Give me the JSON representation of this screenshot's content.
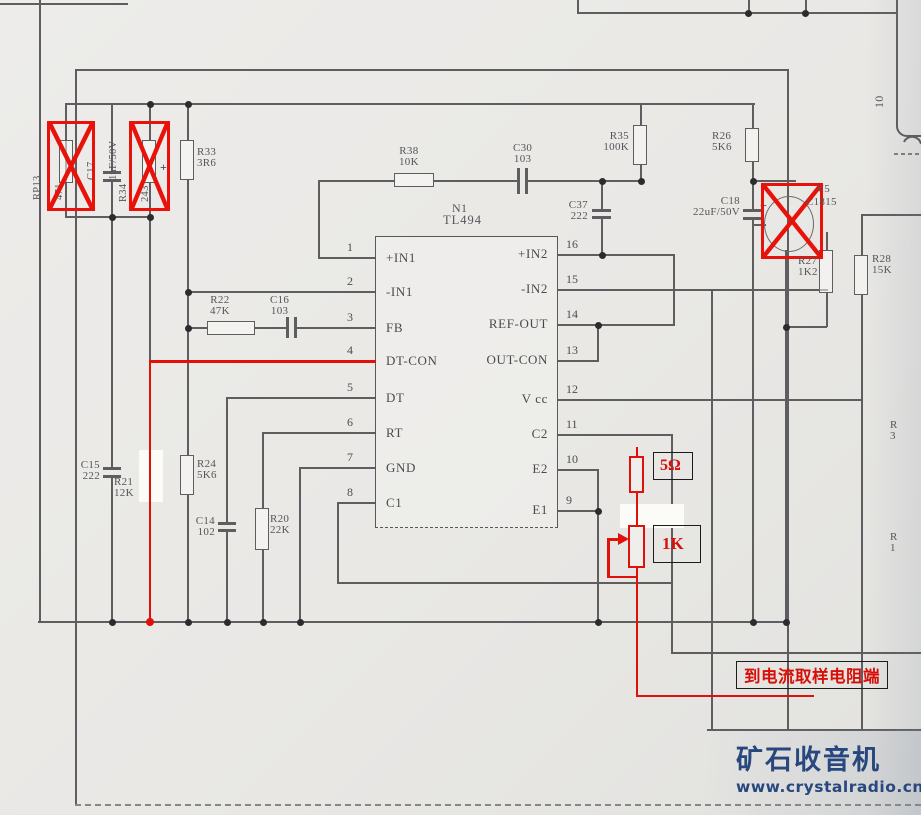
{
  "schematic": {
    "ic": {
      "designator": "N1",
      "part": "TL494",
      "left_pins": [
        {
          "n": "1",
          "label": "+IN1"
        },
        {
          "n": "2",
          "label": "-IN1"
        },
        {
          "n": "3",
          "label": "FB"
        },
        {
          "n": "4",
          "label": "DT-CON"
        },
        {
          "n": "5",
          "label": "DT"
        },
        {
          "n": "6",
          "label": "RT"
        },
        {
          "n": "7",
          "label": "GND"
        },
        {
          "n": "8",
          "label": "C1"
        }
      ],
      "right_pins": [
        {
          "n": "16",
          "label": "+IN2"
        },
        {
          "n": "15",
          "label": "-IN2"
        },
        {
          "n": "14",
          "label": "REF-OUT"
        },
        {
          "n": "13",
          "label": "OUT-CON"
        },
        {
          "n": "12",
          "label": "V cc"
        },
        {
          "n": "11",
          "label": "C2"
        },
        {
          "n": "10",
          "label": "E2"
        },
        {
          "n": "9",
          "label": "E1"
        }
      ]
    },
    "components": {
      "rp13": {
        "ref": "RP13",
        "val": "471"
      },
      "c17": {
        "ref": "C17",
        "val": "1uF/50V"
      },
      "r34": {
        "ref": "R34",
        "val": "243"
      },
      "r33": {
        "ref": "R33",
        "val": "3R6"
      },
      "r38": {
        "ref": "R38",
        "val": "10K"
      },
      "c30": {
        "ref": "C30",
        "val": "103"
      },
      "r35": {
        "ref": "R35",
        "val": "100K"
      },
      "c37": {
        "ref": "C37",
        "val": "222"
      },
      "r26": {
        "ref": "R26",
        "val": "5K6"
      },
      "c18": {
        "ref": "C18",
        "val": "22uF/50V"
      },
      "v5": {
        "ref": "V5",
        "val": "C1815"
      },
      "r27": {
        "ref": "R27",
        "val": "1K2"
      },
      "r28": {
        "ref": "R28",
        "val": "15K"
      },
      "r22": {
        "ref": "R22",
        "val": "47K"
      },
      "c16": {
        "ref": "C16",
        "val": "103"
      },
      "c15": {
        "ref": "C15",
        "val": "222"
      },
      "r21": {
        "ref": "R21",
        "val": "12K"
      },
      "r24": {
        "ref": "R24",
        "val": "5K6"
      },
      "c14": {
        "ref": "C14",
        "val": "102"
      },
      "r20": {
        "ref": "R20",
        "val": "22K"
      }
    },
    "transformer_pin": "10",
    "polarity_plus": "+",
    "edge_labels": [
      {
        "l1": "R",
        "l2": "3"
      },
      {
        "l1": "R",
        "l2": "1"
      }
    ]
  },
  "annotations": {
    "added_resistor": "5Ω",
    "added_pot": "1K",
    "note": "到电流取样电阻端"
  },
  "watermark": {
    "site_name": "矿石收音机",
    "site_url": "www.crystalradio.cn"
  },
  "colors": {
    "annotation_red": "#e0100a",
    "wire_gray": "#5e5e60",
    "watermark_blue": "#27477e"
  }
}
